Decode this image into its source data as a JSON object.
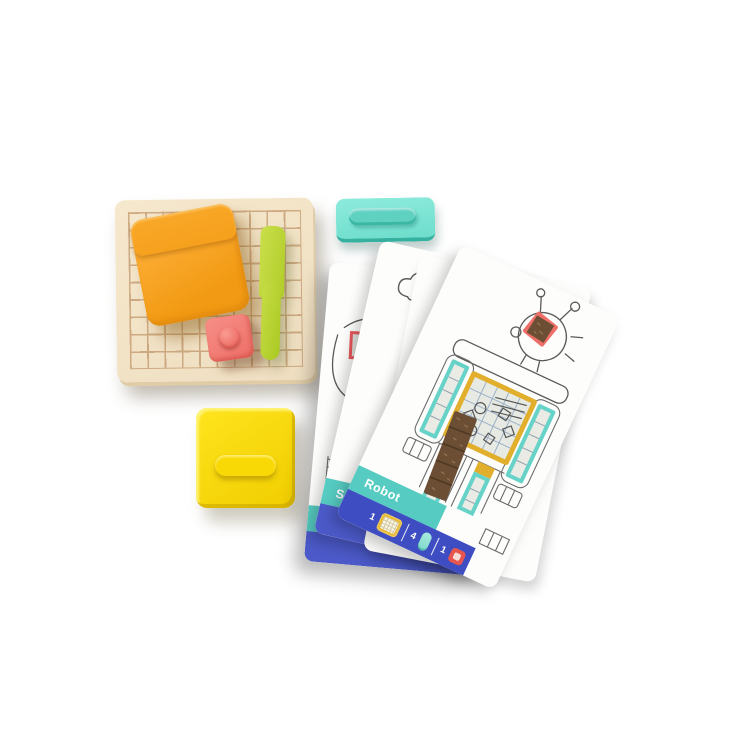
{
  "scene": {
    "background": "#ffffff",
    "description": "Product photo of a kids sand-art activity kit: wooden grid tray with orange sand pouch, red stamp and lime spreader, teal and yellow storage cases, and a fan of activity pattern cards"
  },
  "tray": {
    "grid_cols": 10,
    "grid_rows": 9
  },
  "cards": {
    "top": {
      "title": "Robot",
      "materials": [
        {
          "count": "1",
          "icon": "yellow-grid-plate-icon"
        },
        {
          "count": "4",
          "icon": "teal-strip-icon"
        },
        {
          "count": "1",
          "icon": "red-square-icon"
        }
      ]
    },
    "middle": {
      "title": "Sand Castle"
    },
    "bottom": {
      "title": ""
    }
  },
  "colors": {
    "wood": "#f2e2c6",
    "wood_line": "#c49c72",
    "orange_pouch": "#f5a01e",
    "red_stamp": "#f07b74",
    "lime_tool": "#bcd63a",
    "teal_case": "#7ce2d3",
    "yellow_case": "#f7d500",
    "tab_teal": "#56cbc1",
    "strip_indigo": "#3e4dc2",
    "frame_yellow": "#e2af2d",
    "frame_teal": "#66d2c8",
    "sand_brown": "#6c4e34",
    "sketch_gray": "#5a5a5a"
  }
}
